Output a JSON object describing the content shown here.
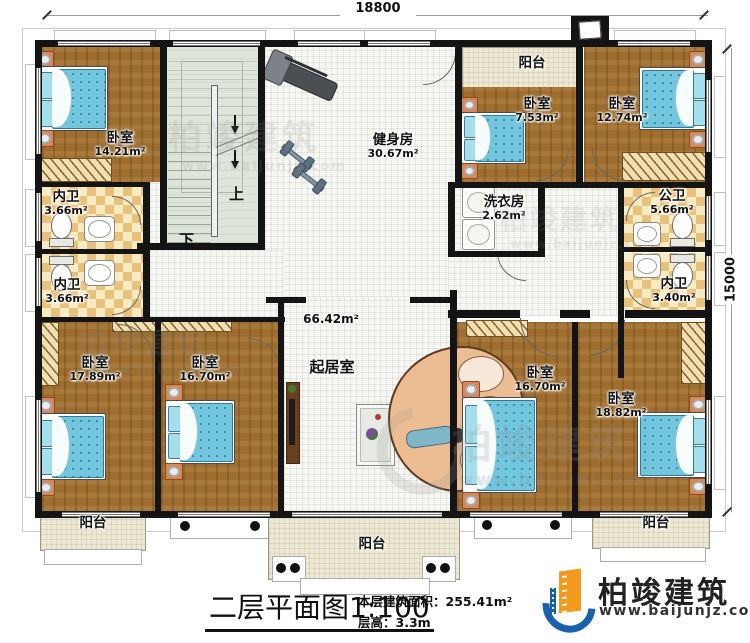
{
  "dimensions": {
    "width_label": "18800",
    "height_label": "15000"
  },
  "stairs": {
    "up": "上",
    "down": "下"
  },
  "rooms": {
    "bedroom_tl": {
      "name": "卧室",
      "area": "14.21m²"
    },
    "bath_left_1": {
      "name": "内卫",
      "area": "3.66m²"
    },
    "bath_left_2": {
      "name": "内卫",
      "area": "3.66m²"
    },
    "gym": {
      "name": "健身房",
      "area": "30.67m²"
    },
    "balcony_top": {
      "name": "阳台"
    },
    "bedroom_tr1": {
      "name": "卧室",
      "area": "7.53m²"
    },
    "bedroom_tr2": {
      "name": "卧室",
      "area": "12.74m²"
    },
    "laundry": {
      "name": "洗衣房",
      "area": "2.62m²"
    },
    "bath_public": {
      "name": "公卫",
      "area": "5.66m²"
    },
    "bath_right": {
      "name": "内卫",
      "area": "3.40m²"
    },
    "living": {
      "name": "起居室",
      "area": "66.42m²"
    },
    "bedroom_bl1": {
      "name": "卧室",
      "area": "17.89m²"
    },
    "bedroom_bl2": {
      "name": "卧室",
      "area": "16.70m²"
    },
    "bedroom_br1": {
      "name": "卧室",
      "area": "16.70m²"
    },
    "bedroom_br2": {
      "name": "卧室",
      "area": "18.82m²"
    },
    "balcony_bottom_left": {
      "name": "阳台"
    },
    "balcony_bottom_center": {
      "name": "阳台"
    },
    "balcony_bottom_right": {
      "name": "阳台"
    }
  },
  "title_block": {
    "title": "二层平面图",
    "scale": "1:100",
    "area_label": "本层建筑面积：",
    "area_value": "255.41m²",
    "floor_height_label": "层高：",
    "floor_height_value": "3.3m"
  },
  "brand": {
    "name": "柏竣建筑",
    "website": "www.baijunjz.com"
  },
  "watermark": {
    "name": "柏竣建筑",
    "website": "www.baijunjz.com"
  },
  "colors": {
    "wall": "#141414",
    "wood": "#9d6e30",
    "checker": "#e9c17a",
    "stair": "#dee5da",
    "balcony": "#ece8d4",
    "bed": "#72c6de",
    "brand_blue": "#1a61ab",
    "brand_orange": "#f29b1f"
  }
}
